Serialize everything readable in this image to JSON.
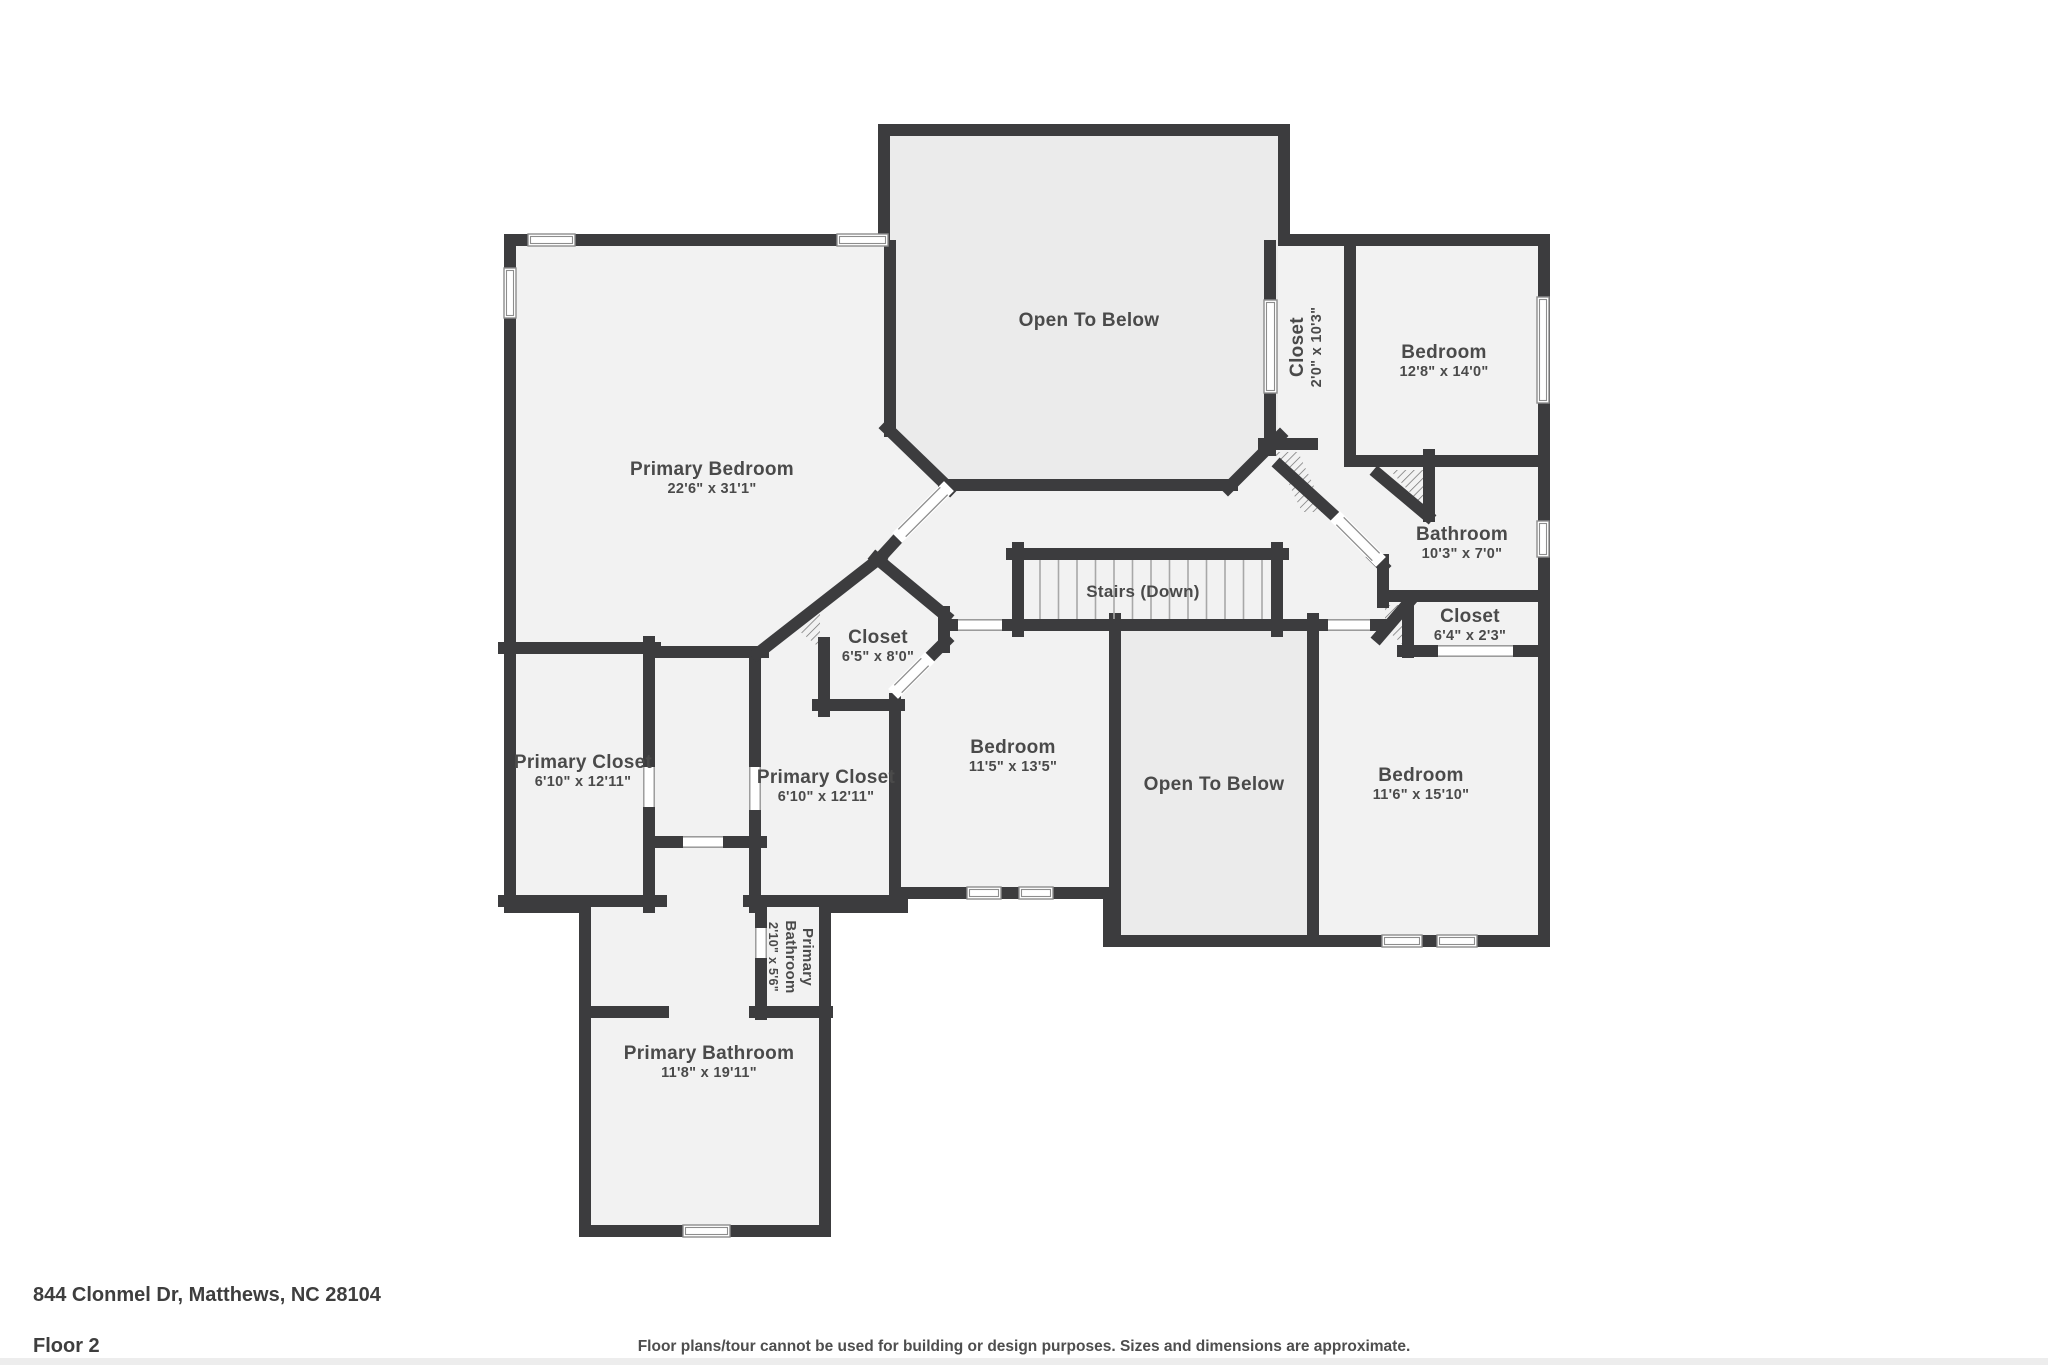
{
  "footer": {
    "address": "844 Clonmel Dr, Matthews, NC 28104",
    "floor": "Floor 2",
    "disclaimer": "Floor plans/tour cannot be used for building or design purposes. Sizes and dimensions are approximate."
  },
  "colors": {
    "wall": "#3c3c3e",
    "floor": "#f2f2f2",
    "open_below_floor": "#ebebeb",
    "label": "#4a4a4a",
    "window_stroke": "#8d8d8d",
    "tread": "#a8a8a8",
    "hatch": "#6b6b6b"
  },
  "plan": {
    "outline": [
      [
        884,
        130
      ],
      [
        1284,
        130
      ],
      [
        1284,
        240
      ],
      [
        1544,
        240
      ],
      [
        1544,
        941
      ],
      [
        1109,
        941
      ],
      [
        1109,
        893
      ],
      [
        902,
        893
      ],
      [
        902,
        907
      ],
      [
        825,
        907
      ],
      [
        825,
        1231
      ],
      [
        585,
        1231
      ],
      [
        585,
        907
      ],
      [
        510,
        907
      ],
      [
        510,
        240
      ],
      [
        884,
        240
      ]
    ],
    "open_below_regions": [
      [
        [
          890,
          136
        ],
        [
          1278,
          136
        ],
        [
          1278,
          430
        ],
        [
          1224,
          484
        ],
        [
          950,
          484
        ],
        [
          890,
          428
        ]
      ],
      [
        [
          1115,
          625
        ],
        [
          1313,
          625
        ],
        [
          1313,
          935
        ],
        [
          1115,
          935
        ]
      ]
    ],
    "walls": [
      [
        890,
        246,
        890,
        431
      ],
      [
        887,
        428,
        950,
        489
      ],
      [
        944,
        485,
        1232,
        485
      ],
      [
        1228,
        488,
        1280,
        436
      ],
      [
        1270,
        246,
        1270,
        450
      ],
      [
        1264,
        444,
        1312,
        444
      ],
      [
        1280,
        466,
        1338,
        519
      ],
      [
        1374,
        557,
        1383,
        566
      ],
      [
        1383,
        560,
        1383,
        602
      ],
      [
        1379,
        637,
        1410,
        601
      ],
      [
        1408,
        598,
        1408,
        652
      ],
      [
        1350,
        247,
        1350,
        461
      ],
      [
        1350,
        461,
        1540,
        461
      ],
      [
        1378,
        474,
        1428,
        516
      ],
      [
        1429,
        455,
        1429,
        516
      ],
      [
        1384,
        596,
        1540,
        596
      ],
      [
        1403,
        651,
        1540,
        651
      ],
      [
        944,
        625,
        1381,
        625
      ],
      [
        1012,
        554,
        1283,
        554
      ],
      [
        1018,
        548,
        1018,
        631
      ],
      [
        1277,
        548,
        1277,
        631
      ],
      [
        1313,
        619,
        1313,
        941
      ],
      [
        1115,
        619,
        1115,
        941
      ],
      [
        895,
        699,
        895,
        907
      ],
      [
        755,
        652,
        755,
        907
      ],
      [
        649,
        642,
        649,
        907
      ],
      [
        504,
        648,
        655,
        648
      ],
      [
        649,
        652,
        763,
        652
      ],
      [
        757,
        654,
        880,
        558
      ],
      [
        880,
        558,
        902,
        534
      ],
      [
        876,
        558,
        946,
        616
      ],
      [
        944,
        612,
        944,
        647
      ],
      [
        946,
        641,
        927,
        660
      ],
      [
        818,
        705,
        899,
        705
      ],
      [
        824,
        643,
        824,
        711
      ],
      [
        655,
        842,
        761,
        842
      ],
      [
        749,
        901,
        901,
        901
      ],
      [
        504,
        901,
        661,
        901
      ],
      [
        761,
        901,
        761,
        1014
      ],
      [
        755,
        1012,
        827,
        1012
      ],
      [
        585,
        1012,
        663,
        1012
      ]
    ],
    "windows": [
      [
        528,
        234,
        47,
        12
      ],
      [
        837,
        234,
        51,
        12
      ],
      [
        504,
        268,
        12,
        50
      ],
      [
        1264,
        300,
        13,
        93
      ],
      [
        1537,
        297,
        12,
        106
      ],
      [
        1537,
        521,
        12,
        36
      ],
      [
        1382,
        935,
        40,
        12
      ],
      [
        1437,
        935,
        40,
        12
      ],
      [
        967,
        887,
        34,
        12
      ],
      [
        1019,
        887,
        34,
        12
      ],
      [
        683,
        1225,
        47,
        12
      ]
    ],
    "gaps": [
      [
        1438,
        645,
        75,
        12
      ],
      [
        958,
        619,
        44,
        12
      ],
      [
        1328,
        619,
        42,
        12
      ],
      [
        643,
        767,
        12,
        40
      ],
      [
        749,
        767,
        12,
        43
      ],
      [
        755,
        928,
        12,
        30
      ],
      [
        683,
        836,
        40,
        12
      ]
    ],
    "doors": [
      [
        902,
        533,
        944,
        491
      ],
      [
        925,
        662,
        898,
        689
      ],
      [
        1340,
        521,
        1376,
        557
      ]
    ],
    "hatches": [
      [
        [
          1274,
          452
        ],
        [
          1298,
          452
        ],
        [
          1326,
          512
        ],
        [
          1302,
          512
        ]
      ],
      [
        [
          1390,
          470
        ],
        [
          1424,
          470
        ],
        [
          1424,
          508
        ]
      ],
      [
        [
          1385,
          605
        ],
        [
          1403,
          605
        ],
        [
          1403,
          645
        ],
        [
          1385,
          628
        ]
      ],
      [
        [
          798,
          630
        ],
        [
          820,
          613
        ],
        [
          820,
          648
        ]
      ]
    ],
    "stairs": {
      "x1": 1040,
      "x2": 1262,
      "y1": 560,
      "y2": 619,
      "treads": 12
    },
    "labels": [
      {
        "id": "primary-bedroom",
        "x": 712,
        "y": 475,
        "lines": [
          "Primary Bedroom",
          "22'6\" x 31'1\""
        ]
      },
      {
        "id": "open-to-below-top",
        "x": 1089,
        "y": 326,
        "lines": [
          "Open To Below"
        ]
      },
      {
        "id": "closet-top",
        "x": 1303,
        "y": 347,
        "rot": -90,
        "lines": [
          "Closet",
          "2'0\" x 10'3\""
        ]
      },
      {
        "id": "bedroom-top-right",
        "x": 1444,
        "y": 358,
        "lines": [
          "Bedroom",
          "12'8\" x 14'0\""
        ]
      },
      {
        "id": "bathroom",
        "x": 1462,
        "y": 540,
        "lines": [
          "Bathroom",
          "10'3\" x 7'0\""
        ]
      },
      {
        "id": "closet-64",
        "x": 1470,
        "y": 622,
        "lines": [
          "Closet",
          "6'4\" x 2'3\""
        ]
      },
      {
        "id": "stairs-label",
        "x": 1143,
        "y": 597,
        "size": 17,
        "lines": [
          "Stairs (Down)"
        ]
      },
      {
        "id": "closet-octagon",
        "x": 878,
        "y": 643,
        "lines": [
          "Closet",
          "6'5\" x 8'0\""
        ]
      },
      {
        "id": "primary-closet-1",
        "x": 583,
        "y": 768,
        "lines": [
          "Primary Closet",
          "6'10\" x 12'11\""
        ]
      },
      {
        "id": "primary-closet-2",
        "x": 826,
        "y": 783,
        "lines": [
          "Primary Closet",
          "6'10\" x 12'11\""
        ]
      },
      {
        "id": "bedroom-115",
        "x": 1013,
        "y": 753,
        "lines": [
          "Bedroom",
          "11'5\" x 13'5\""
        ]
      },
      {
        "id": "open-to-below-center",
        "x": 1214,
        "y": 790,
        "lines": [
          "Open To Below"
        ]
      },
      {
        "id": "bedroom-116",
        "x": 1421,
        "y": 781,
        "lines": [
          "Bedroom",
          "11'6\" x 15'10\""
        ]
      },
      {
        "id": "primary-bathroom-small",
        "x": 786,
        "y": 957,
        "rot": 90,
        "size": 15,
        "dsize": 12.5,
        "lines": [
          "Primary",
          "Bathroom",
          "2'10\" x 5'6\""
        ]
      },
      {
        "id": "primary-bathroom",
        "x": 709,
        "y": 1059,
        "lines": [
          "Primary Bathroom",
          "11'8\" x 19'11\""
        ]
      }
    ]
  }
}
